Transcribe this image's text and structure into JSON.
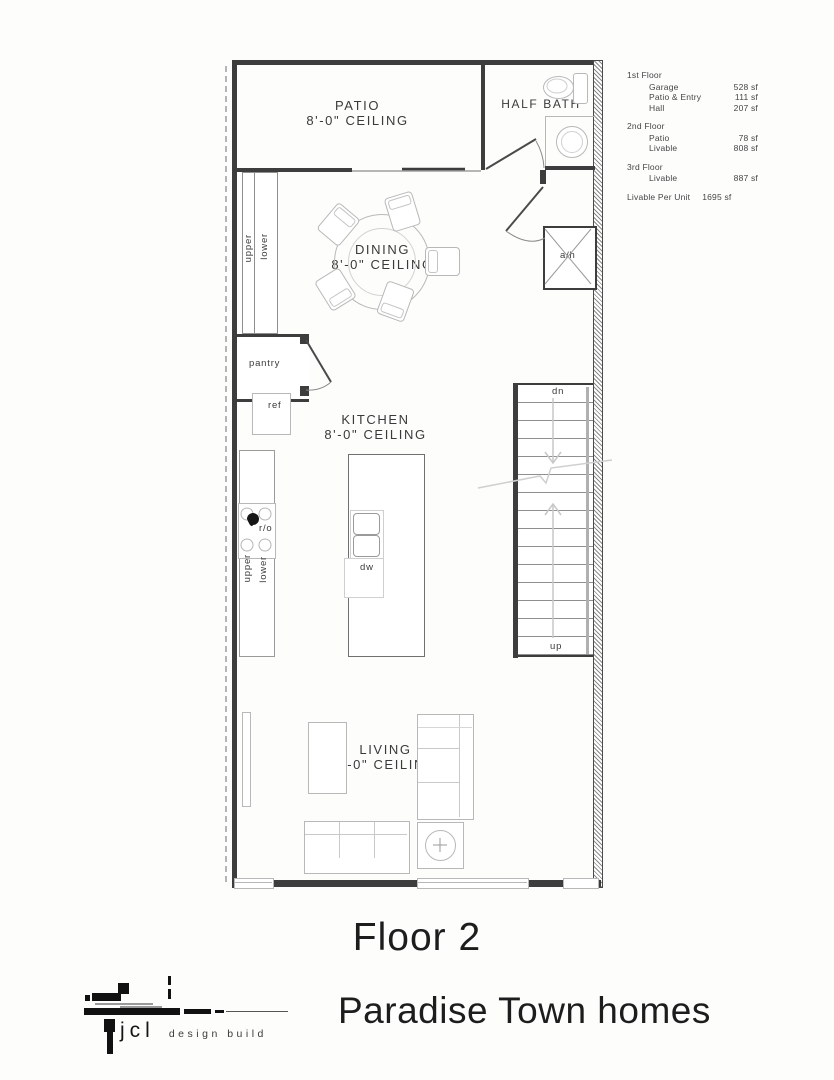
{
  "area_table": {
    "sections": [
      {
        "title": "1st Floor",
        "rows": [
          {
            "name": "Garage",
            "value": "528 sf"
          },
          {
            "name": "Patio & Entry",
            "value": "111 sf"
          },
          {
            "name": "Hall",
            "value": "207 sf"
          }
        ]
      },
      {
        "title": "2nd Floor",
        "rows": [
          {
            "name": "Patio",
            "value": "78 sf"
          },
          {
            "name": "Livable",
            "value": "808 sf"
          }
        ]
      },
      {
        "title": "3rd Floor",
        "rows": [
          {
            "name": "Livable",
            "value": "887 sf"
          }
        ]
      }
    ],
    "total_label": "Livable Per Unit",
    "total_value": "1695 sf"
  },
  "rooms": {
    "patio": {
      "name": "PATIO",
      "ceiling": "8'-0\" CEILING"
    },
    "half_bath": {
      "name": "HALF BATH"
    },
    "dining": {
      "name": "DINING",
      "ceiling": "8'-0\" CEILING"
    },
    "kitchen": {
      "name": "KITCHEN",
      "ceiling": "8'-0\" CEILING"
    },
    "living": {
      "name": "LIVING",
      "ceiling": "8'-0\" CEILING"
    },
    "pantry": {
      "name": "pantry"
    }
  },
  "labels": {
    "upper": "upper",
    "lower": "lower",
    "ref": "ref",
    "range": "r/o",
    "dishwasher": "dw",
    "air_handler": "a/h",
    "stairs_down": "dn",
    "stairs_up": "up"
  },
  "titles": {
    "floor": "Floor 2",
    "project": "Paradise Town homes"
  },
  "logo": {
    "name": "jcl",
    "tagline": "design build"
  },
  "colors": {
    "wall": "#3d3d3d",
    "furniture_line": "#b8b8b8",
    "text": "#3a3a3a"
  }
}
